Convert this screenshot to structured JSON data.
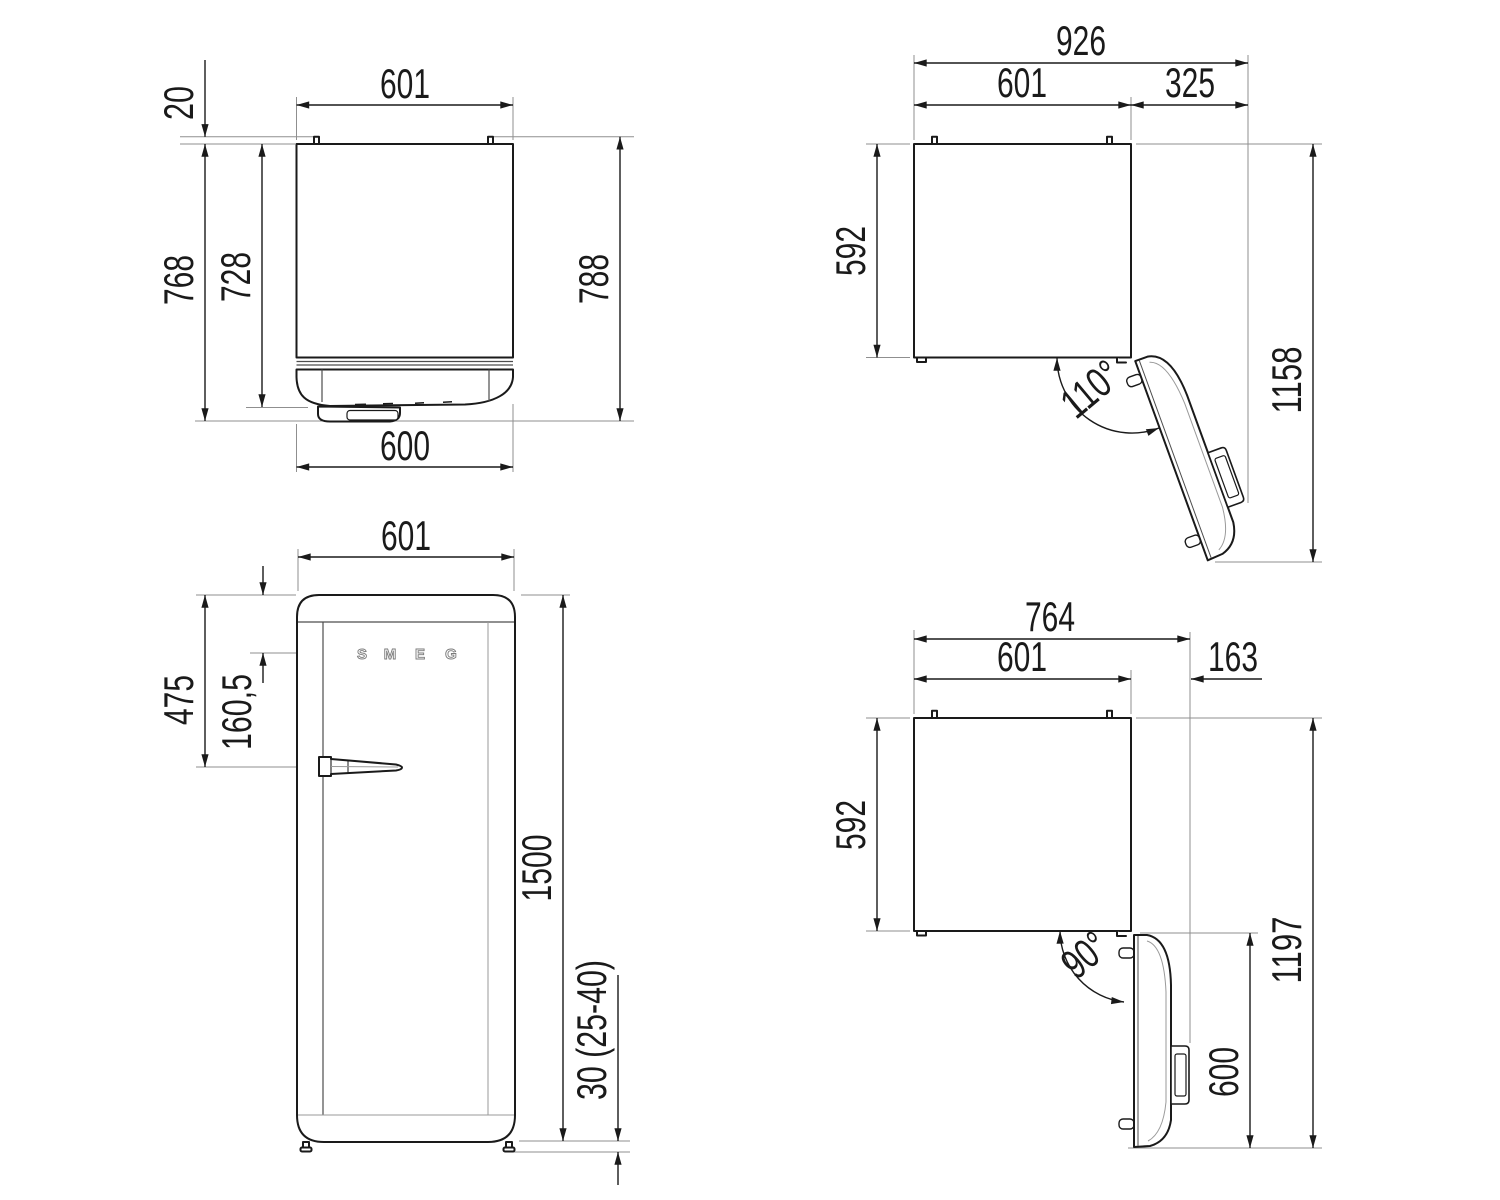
{
  "drawing": {
    "colors": {
      "line": "#1a1a1a",
      "extension": "#8f8f8f",
      "logo": "#7a7a7a",
      "background": "#ffffff"
    },
    "views": {
      "plan_closed": {
        "width_top": "601",
        "hinge_pin_depth": "20",
        "depth_with_door": "768",
        "depth_to_door_face": "728",
        "depth_total": "788",
        "door_width": "600"
      },
      "plan_open_110": {
        "total_width": "926",
        "body_width": "601",
        "side_clearance": "325",
        "body_depth": "592",
        "total_depth_open": "1158",
        "opening_angle": "110°"
      },
      "front": {
        "body_width": "601",
        "handle_offset": "475",
        "logo_offset": "160,5",
        "height": "1500",
        "feet_height": "30 (25-40)",
        "logo": [
          "S",
          "M",
          "E",
          "G"
        ]
      },
      "plan_open_90": {
        "total_width": "764",
        "body_width": "601",
        "side_clearance": "163",
        "body_depth": "592",
        "total_depth_open": "1197",
        "door_width_open": "600",
        "opening_angle": "90°"
      }
    }
  }
}
